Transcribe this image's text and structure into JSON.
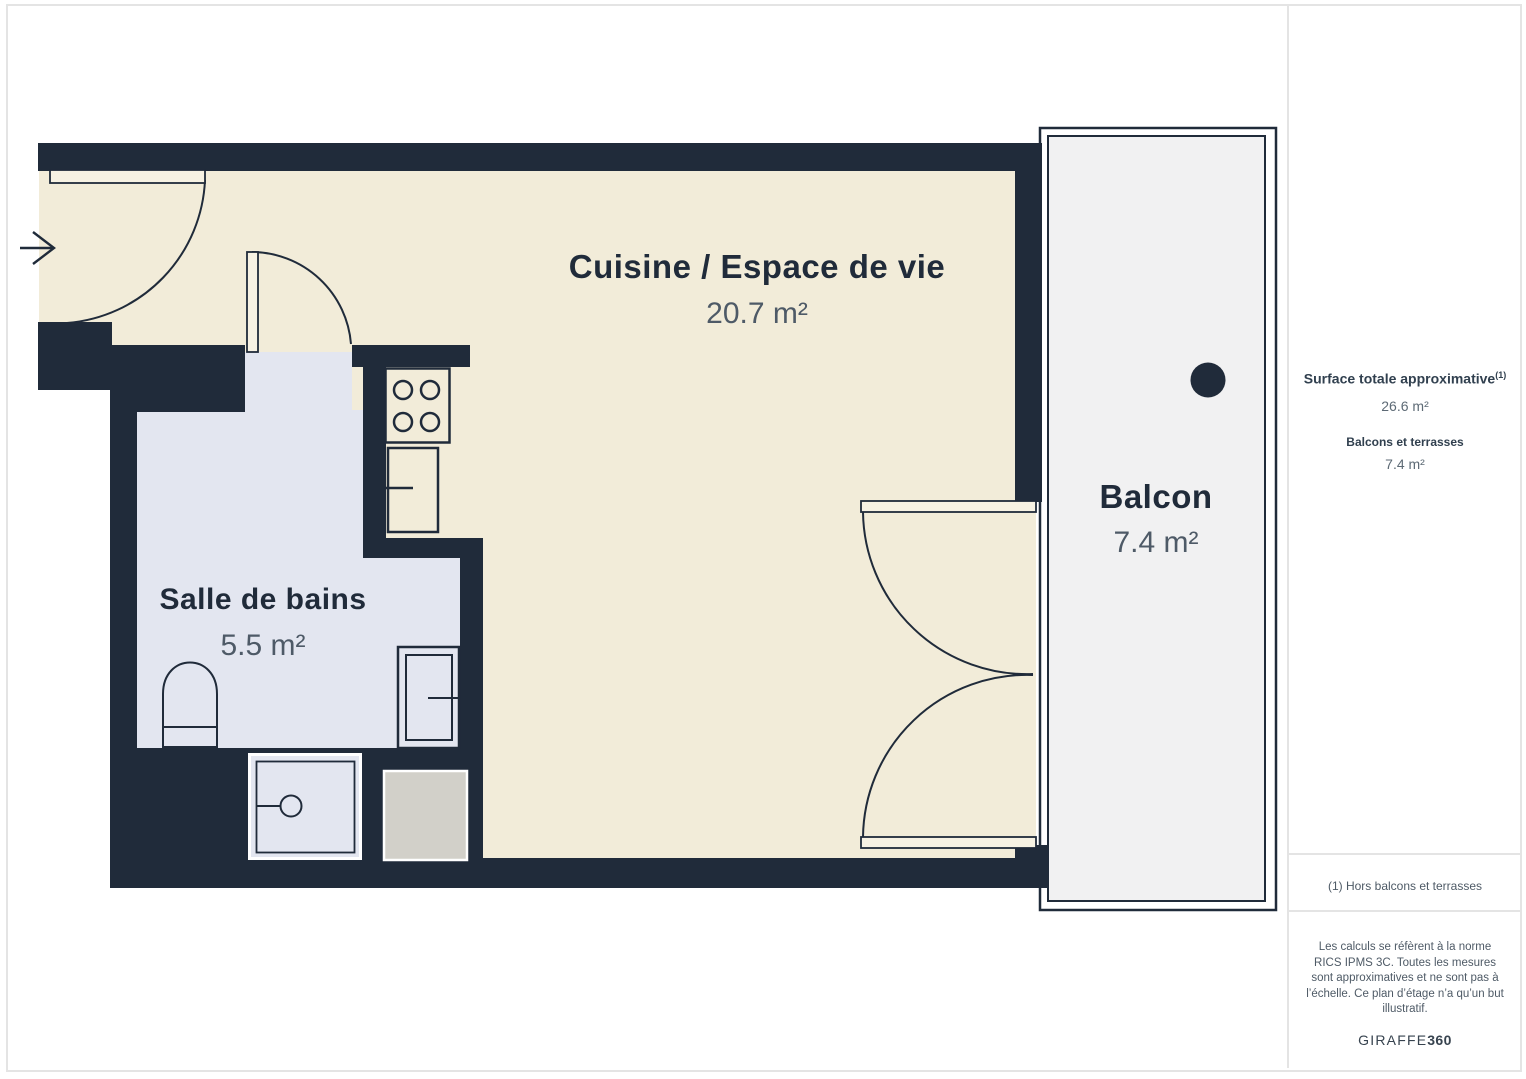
{
  "plan": {
    "rooms": [
      {
        "name": "Cuisine / Espace de vie",
        "area": "20.7 m²"
      },
      {
        "name": "Salle de bains",
        "area": "5.5 m²"
      },
      {
        "name": "Balcon",
        "area": "7.4 m²"
      }
    ],
    "icons": {
      "entrance_arrow": "entrance-arrow",
      "camera_point": "camera-point-dot"
    },
    "colors": {
      "wall": "#202b3a",
      "floor_main": "#f2ecd9",
      "floor_bath": "#e3e6f0",
      "floor_balcony": "#f1f1f2",
      "appliance_gray": "#d2d0c9",
      "label_dark": "#202b3a",
      "label_muted": "#4e5a67"
    }
  },
  "sidebar": {
    "total_label": "Surface totale approximative",
    "total_sup": "(1)",
    "total_value": "26.6 m²",
    "balcony_label": "Balcons et terrasses",
    "balcony_value": "7.4 m²",
    "note": "(1) Hors balcons et terrasses",
    "disclaimer": "Les calculs se réfèrent à la norme RICS IPMS 3C. Toutes les mesures sont approximatives et ne sont pas à l’échelle. Ce plan d’étage n’a qu’un but illustratif.",
    "logo_text": "GIRAFFE",
    "logo_suffix": "360"
  }
}
